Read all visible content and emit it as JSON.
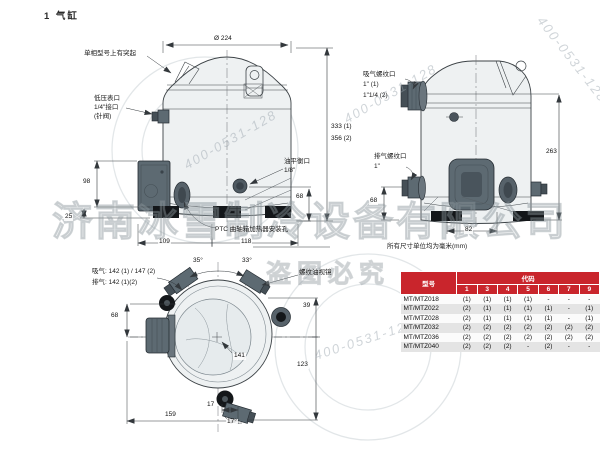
{
  "page": {
    "title": "1  气缸"
  },
  "note": "所有尺寸单位均为毫米(mm)",
  "front_view": {
    "labels": {
      "protrusion": "单相型号上有突起",
      "lp1": "低压表口",
      "lp2": "1/4\"接口",
      "lp3": "(针阀)",
      "oil1": "油平衡口",
      "oil2": "1/8\"",
      "ptc": "PTC 曲轴箱加热器安装孔"
    },
    "dims": {
      "diameter": "Ø 224",
      "h98": "98",
      "h25": "25",
      "h68": "68",
      "w109": "109",
      "w118": "118"
    }
  },
  "side_view": {
    "labels": {
      "suction1": "吸气螺纹口",
      "suction2": "1\" (1)",
      "suction3": "1\"1/4 (2)",
      "discharge1": "排气螺纹口",
      "discharge2": "1\""
    },
    "dims": {
      "h333": "333 (1)",
      "h356": "356 (2)",
      "h263": "263",
      "h68": "68",
      "w82": "82"
    }
  },
  "bottom_view": {
    "labels": {
      "suction": "吸气: 142 (1) / 147 (2)",
      "discharge": "排气: 142 (1)(2)",
      "sight_glass": "螺纹油视镜"
    },
    "dims": {
      "a35": "35°",
      "a33": "33°",
      "d39": "39",
      "d123": "123",
      "d141": "141",
      "d68": "68",
      "d159": "159",
      "d17": "17",
      "a17": "17°"
    }
  },
  "table": {
    "col_model": "型号",
    "col_code": "代码",
    "code_cols": [
      "1",
      "3",
      "4",
      "5",
      "6",
      "7",
      "9"
    ],
    "rows": [
      {
        "model": "MT/MTZ018",
        "values": [
          "(1)",
          "(1)",
          "(1)",
          "(1)",
          "-",
          "-",
          "-"
        ]
      },
      {
        "model": "MT/MTZ022",
        "values": [
          "(2)",
          "(1)",
          "(1)",
          "(1)",
          "(1)",
          "-",
          "(1)"
        ]
      },
      {
        "model": "MT/MTZ028",
        "values": [
          "(2)",
          "(1)",
          "(1)",
          "(1)",
          "(1)",
          "-",
          "(1)"
        ]
      },
      {
        "model": "MT/MTZ032",
        "values": [
          "(2)",
          "(2)",
          "(2)",
          "(2)",
          "(2)",
          "(2)",
          "(2)"
        ]
      },
      {
        "model": "MT/MTZ036",
        "values": [
          "(2)",
          "(2)",
          "(2)",
          "(2)",
          "(2)",
          "(2)",
          "(2)"
        ]
      },
      {
        "model": "MT/MTZ040",
        "values": [
          "(2)",
          "(2)",
          "(2)",
          "-",
          "(2)",
          "-",
          "-"
        ]
      }
    ],
    "header_color": "#c9252c"
  },
  "watermark": {
    "company": "济南冰雪制冷设备有限公司",
    "phone": "400-0531-128",
    "notice": "盗图必究"
  }
}
